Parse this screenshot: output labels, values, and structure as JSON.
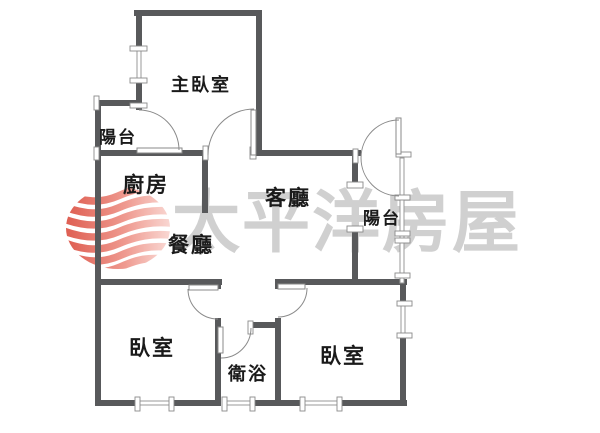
{
  "page": {
    "background": "#ffffff",
    "type": "floor-plan"
  },
  "watermark": {
    "brand_text": "太平洋房屋",
    "color": "#c8c8c8",
    "logo_icon": "pacific-house-globe-logo",
    "logo_red": "#df564a"
  },
  "colors": {
    "wall": "#58595b",
    "thin_line": "#9a9a9a",
    "door_line": "#8a8a8a",
    "label": "#1a1a1a",
    "background": "#ffffff"
  },
  "rooms": [
    {
      "id": "master-bedroom",
      "label": "主臥室"
    },
    {
      "id": "balcony-left",
      "label": "陽台"
    },
    {
      "id": "kitchen",
      "label": "廚房"
    },
    {
      "id": "dining-room",
      "label": "餐廳"
    },
    {
      "id": "living-room",
      "label": "客廳"
    },
    {
      "id": "balcony-right",
      "label": "陽台"
    },
    {
      "id": "bedroom-left",
      "label": "臥室"
    },
    {
      "id": "bathroom",
      "label": "衛浴"
    },
    {
      "id": "bedroom-right",
      "label": "臥室"
    }
  ]
}
